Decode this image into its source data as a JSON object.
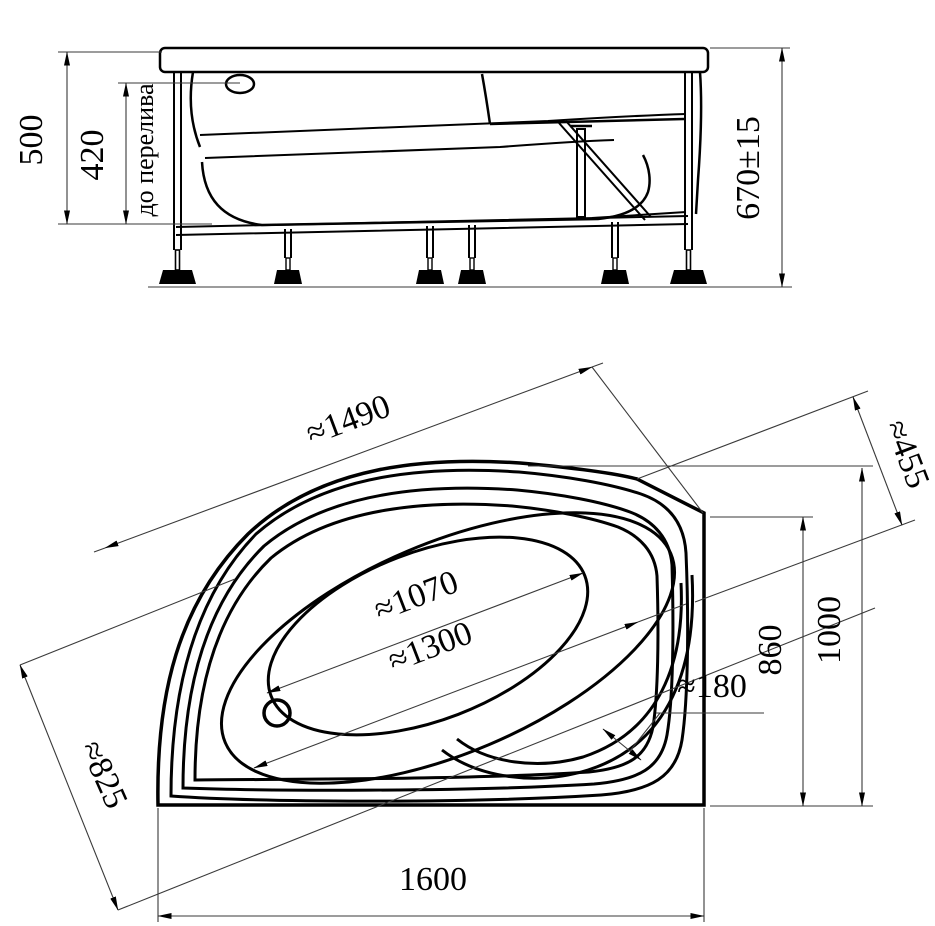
{
  "side_view": {
    "height_total": "500",
    "height_to_overflow": "420",
    "overflow_label": "до перелива",
    "mounting_height": "670±15"
  },
  "plan_view": {
    "rim_diagonal_length": "≈1490",
    "corner_cut_width": "≈455",
    "basin_length": "≈1070",
    "interior_length": "≈1300",
    "seat_width": "≈180",
    "depth_to_corner": "860",
    "overall_depth": "1000",
    "overall_width": "1600",
    "left_side_length": "≈825"
  },
  "colors": {
    "line": "#000000",
    "thin_line": "#3a3a3a",
    "background": "#ffffff"
  }
}
